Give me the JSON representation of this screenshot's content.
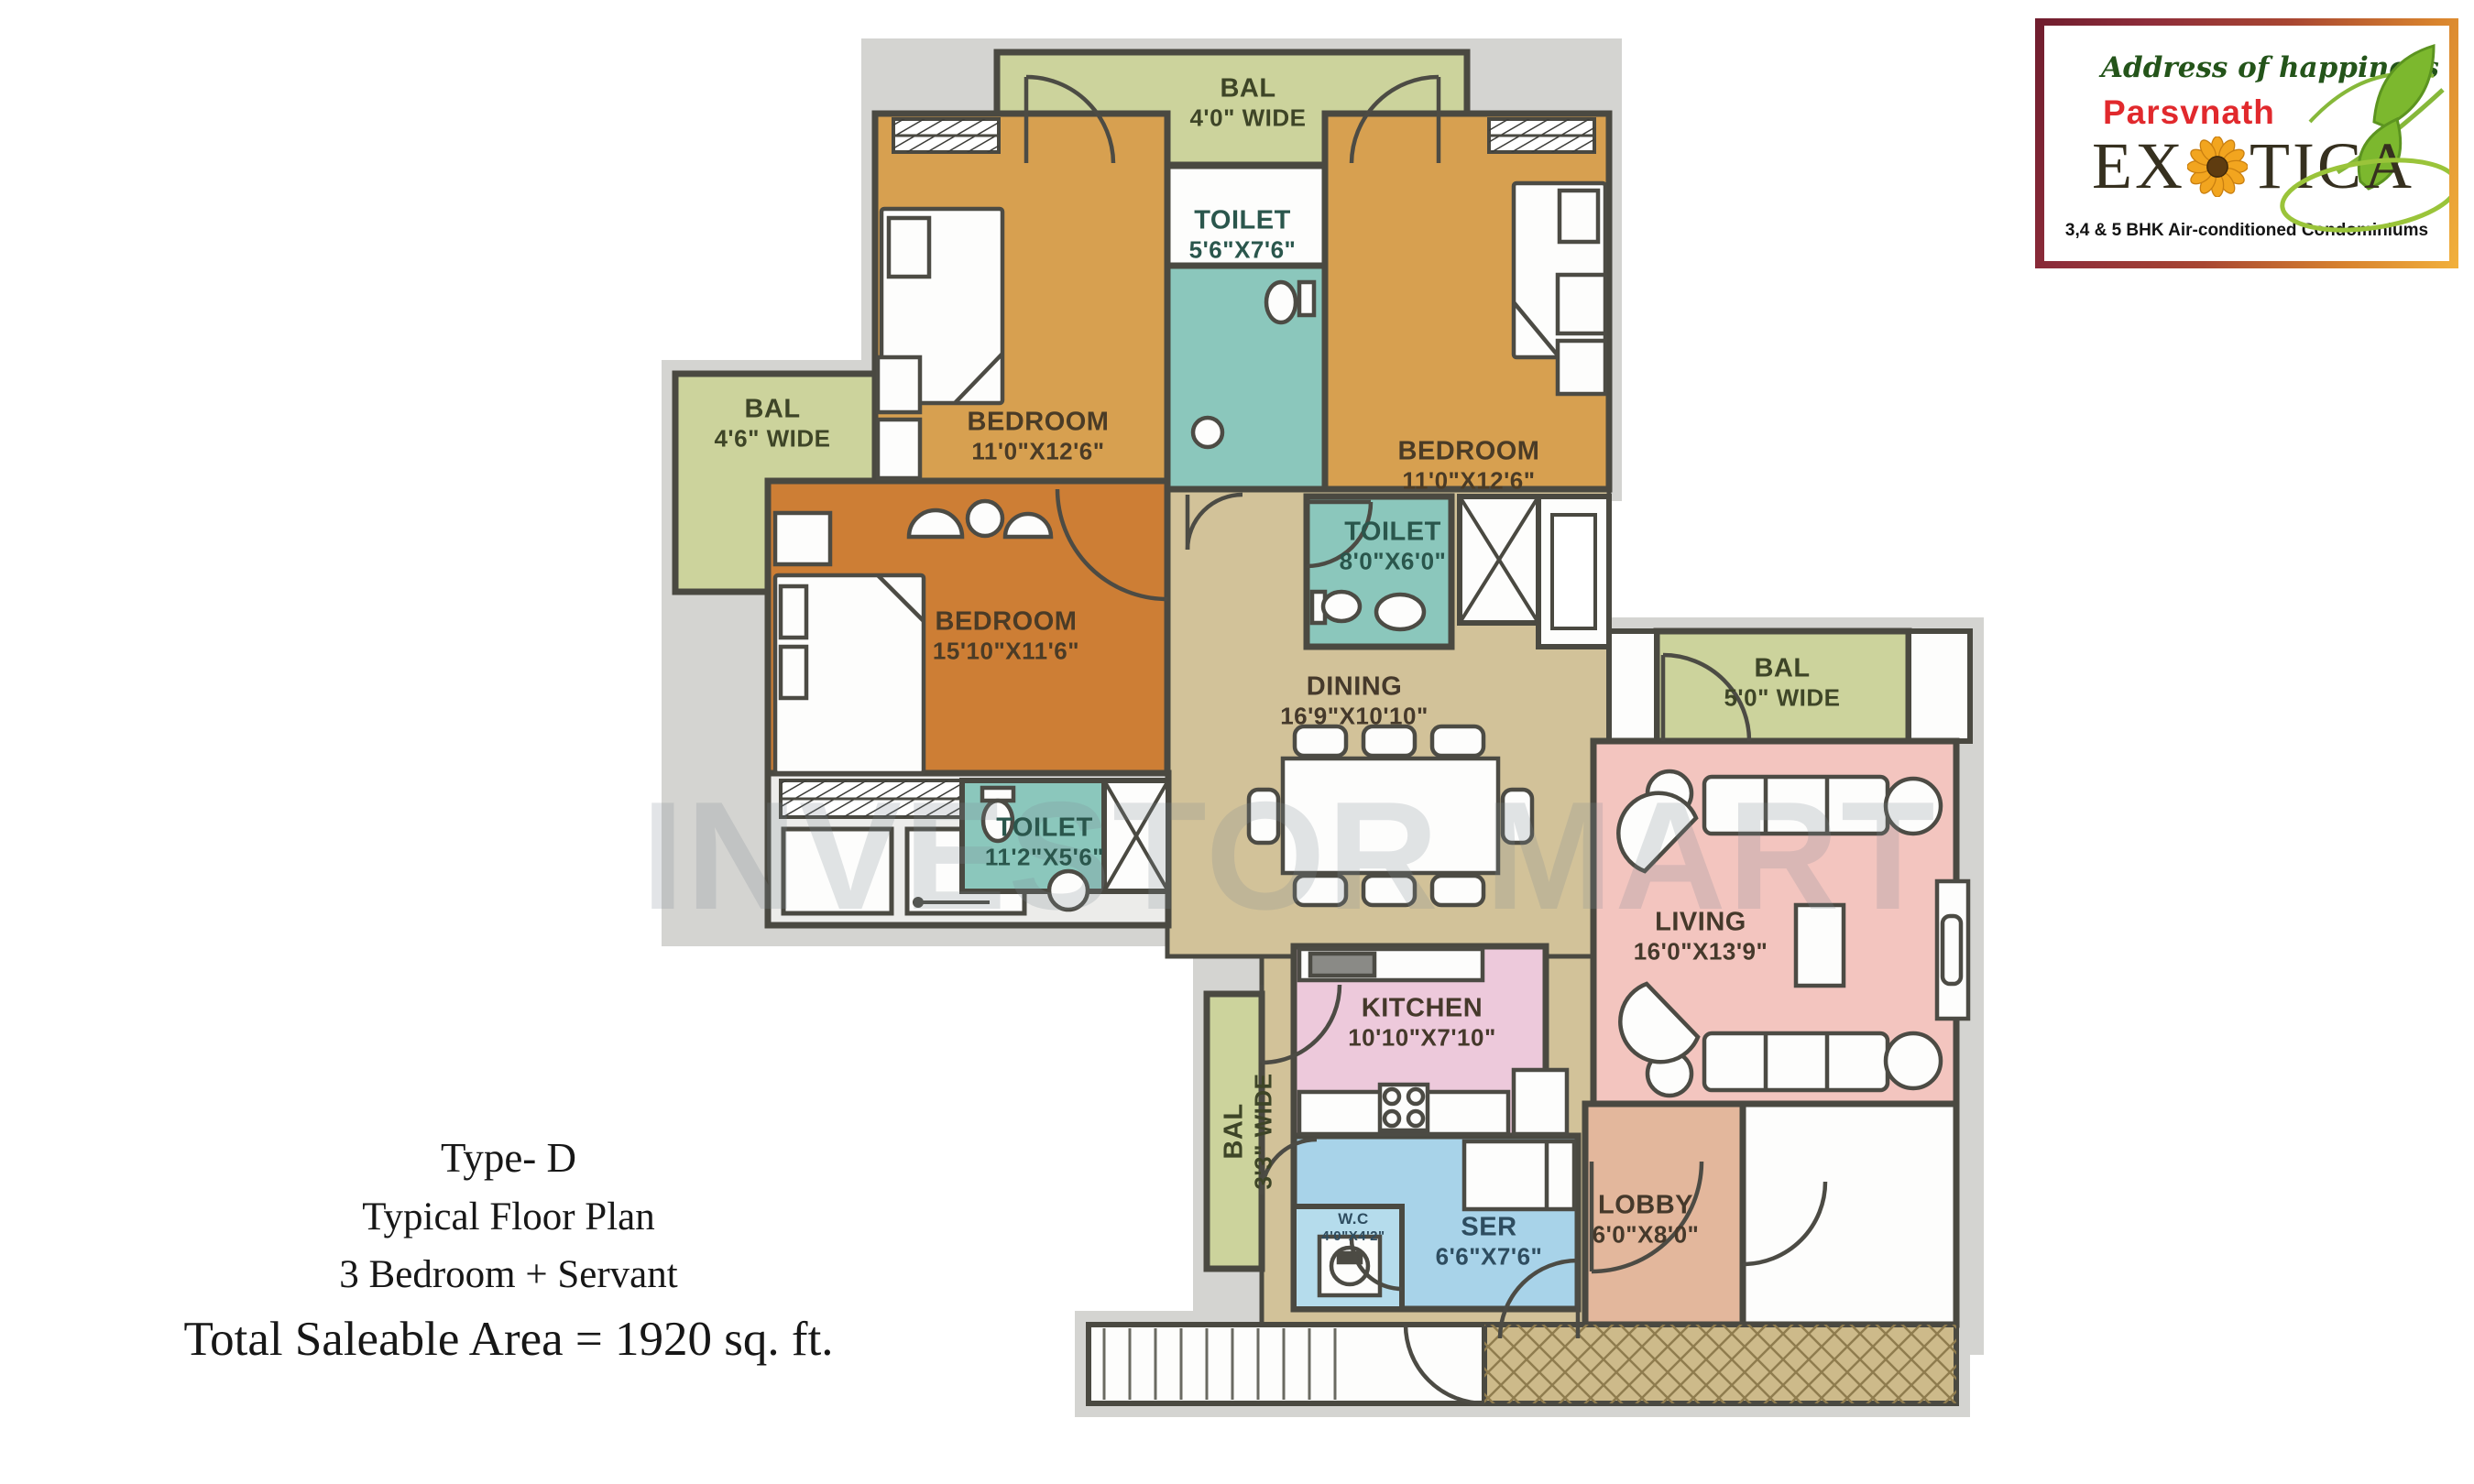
{
  "watermark": "INVESTOR MART",
  "title_block": {
    "line1": "Type- D",
    "line2": "Typical Floor Plan",
    "line3": "3 Bedroom + Servant",
    "line4": "Total Saleable Area = 1920 sq. ft."
  },
  "logo": {
    "tagline": "Address of happiness",
    "brand": "Parsvnath",
    "name": "EXOTICA",
    "name_left": "EX",
    "name_right": "TICA",
    "subtitle": "3,4 & 5 BHK Air-conditioned Condominiums"
  },
  "rooms": {
    "bal_top": {
      "name": "BAL",
      "dim": "4'0\" WIDE"
    },
    "toilet_top": {
      "name": "TOILET",
      "dim": "5'6\"X7'6\""
    },
    "bedroom_tl": {
      "name": "BEDROOM",
      "dim": "11'0\"X12'6\""
    },
    "bedroom_tr": {
      "name": "BEDROOM",
      "dim": "11'0\"X12'6\""
    },
    "bal_left": {
      "name": "BAL",
      "dim": "4'6\" WIDE"
    },
    "bedroom_master": {
      "name": "BEDROOM",
      "dim": "15'10\"X11'6\""
    },
    "toilet_mid": {
      "name": "TOILET",
      "dim": "8'0\"X6'0\""
    },
    "dining": {
      "name": "DINING",
      "dim": "16'9\"X10'10\""
    },
    "bal_right": {
      "name": "BAL",
      "dim": "5'0\" WIDE"
    },
    "living": {
      "name": "LIVING",
      "dim": "16'0\"X13'9\""
    },
    "toilet_lower": {
      "name": "TOILET",
      "dim": "11'2\"X5'6\""
    },
    "kitchen": {
      "name": "KITCHEN",
      "dim": "10'10\"X7'10\""
    },
    "bal_bottom": {
      "name": "BAL",
      "dim": "3'3\" WIDE"
    },
    "wc": {
      "name": "W.C",
      "dim": "4'0\"X4'2\""
    },
    "servant": {
      "name": "SER",
      "dim": "6'6\"X7'6\""
    },
    "lobby": {
      "name": "LOBBY",
      "dim": "6'0\"X8'0\""
    }
  },
  "colors": {
    "bedroom_amber": "#d7a050",
    "bedroom_master": "#cd7e35",
    "toilet_teal": "#8bc7bc",
    "corridor_tan": "#d2c299",
    "living_pink": "#f3c5bf",
    "kitchen_pink": "#edc9db",
    "servant_blue": "#a8d3e9",
    "wc_blue": "#b5dcec",
    "lobby_peach": "#e3b79c",
    "balcony_green": "#ccd39c",
    "hatch_tan": "#cdba8a",
    "zone_gray": "#ececea",
    "wall_light": "#d4d4d1",
    "white_area": "#fdfdfc"
  }
}
